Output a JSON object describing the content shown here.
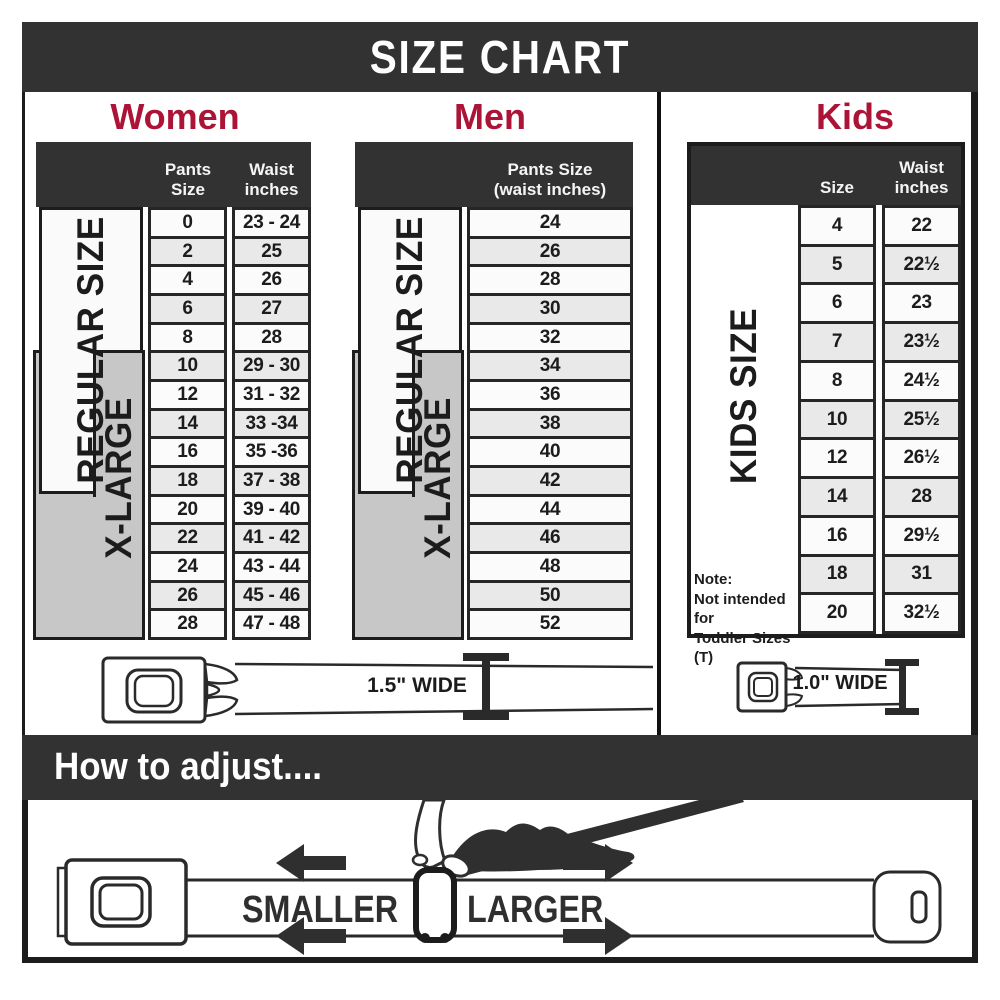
{
  "title": "SIZE CHART",
  "colors": {
    "band_dark": "#323232",
    "accent_red": "#ac1437",
    "row_alt_gray": "#e9e9e9",
    "xlarge_gray": "#c7c7c7",
    "border_dark": "#1c1c1c"
  },
  "women": {
    "heading": "Women",
    "col_size": "Pants Size",
    "col_waist": "Waist\ninches",
    "regular_label": "REGULAR SIZE",
    "xlarge_label": "X-LARGE",
    "belt_width_label": "1.5\" WIDE",
    "rows": [
      {
        "size": "0",
        "waist": "23 - 24"
      },
      {
        "size": "2",
        "waist": "25"
      },
      {
        "size": "4",
        "waist": "26"
      },
      {
        "size": "6",
        "waist": "27"
      },
      {
        "size": "8",
        "waist": "28"
      },
      {
        "size": "10",
        "waist": "29 - 30"
      },
      {
        "size": "12",
        "waist": "31 - 32"
      },
      {
        "size": "14",
        "waist": "33 -34"
      },
      {
        "size": "16",
        "waist": "35 -36"
      },
      {
        "size": "18",
        "waist": "37 - 38"
      },
      {
        "size": "20",
        "waist": "39 - 40"
      },
      {
        "size": "22",
        "waist": "41 - 42"
      },
      {
        "size": "24",
        "waist": "43 - 44"
      },
      {
        "size": "26",
        "waist": "45 - 46"
      },
      {
        "size": "28",
        "waist": "47 - 48"
      }
    ]
  },
  "men": {
    "heading": "Men",
    "col_header": "Pants Size\n(waist inches)",
    "regular_label": "REGULAR SIZE",
    "xlarge_label": "X-LARGE",
    "rows": [
      "24",
      "26",
      "28",
      "30",
      "32",
      "34",
      "36",
      "38",
      "40",
      "42",
      "44",
      "46",
      "48",
      "50",
      "52"
    ]
  },
  "kids": {
    "heading": "Kids",
    "col_size": "Size",
    "col_waist": "Waist\ninches",
    "side_label": "KIDS SIZE",
    "note": "Note:\nNot intended for\nToddler Sizes (T)",
    "belt_width_label": "1.0\" WIDE",
    "rows": [
      {
        "size": "4",
        "waist": "22"
      },
      {
        "size": "5",
        "waist": "22½"
      },
      {
        "size": "6",
        "waist": "23"
      },
      {
        "size": "7",
        "waist": "23½"
      },
      {
        "size": "8",
        "waist": "24½"
      },
      {
        "size": "10",
        "waist": "25½"
      },
      {
        "size": "12",
        "waist": "26½"
      },
      {
        "size": "14",
        "waist": "28"
      },
      {
        "size": "16",
        "waist": "29½"
      },
      {
        "size": "18",
        "waist": "31"
      },
      {
        "size": "20",
        "waist": "32½"
      }
    ]
  },
  "adjust": {
    "title": "How to adjust....",
    "smaller": "SMALLER",
    "larger": "LARGER"
  }
}
